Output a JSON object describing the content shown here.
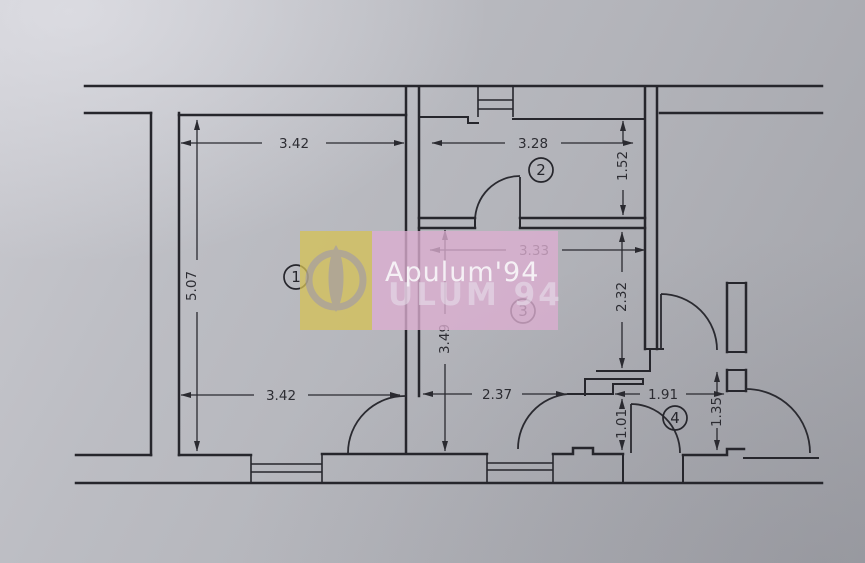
{
  "watermark": {
    "brand_text": "Apulum'94",
    "ghost_text": "ULUM 94",
    "yellow_panel_color": "#d6c254",
    "pink_panel_color": "#dcaed1",
    "brand_text_color": "#f7f4f8",
    "ghost_text_color": "#e9e2ee",
    "emblem_color": "#8f8cc0"
  },
  "rooms": [
    {
      "label": "1"
    },
    {
      "label": "2"
    },
    {
      "label": "3"
    },
    {
      "label": "4"
    }
  ],
  "dimensions": {
    "room1_width_top": "3.42",
    "room1_height": "5.07",
    "room1_width_bottom": "3.42",
    "room2_width": "3.28",
    "room2_height": "1.52",
    "room3_width": "3.33",
    "room3_height": "2.32",
    "hall_height": "3.49",
    "hall_width": "2.37",
    "corridor_width": "1.91",
    "corridor_height": "1.01",
    "entry_height": "1.35"
  },
  "colors": {
    "paper": "#b3b4ba",
    "ink": "#26262c"
  }
}
